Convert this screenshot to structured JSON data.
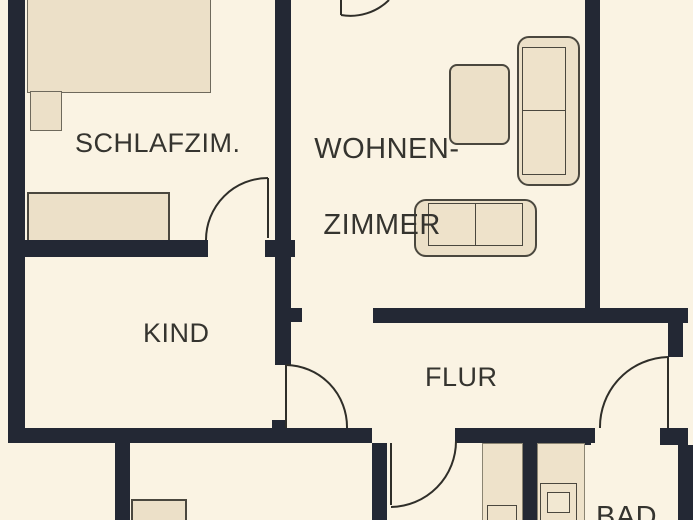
{
  "plan": {
    "type": "apartment-floor-plan",
    "language": "de"
  },
  "rooms": {
    "bedroom": {
      "label": "SCHLAFZIM."
    },
    "living": {
      "label_line1": "WOHNEN-",
      "label_line2": "ZIMMER"
    },
    "child": {
      "label": "KIND"
    },
    "hall": {
      "label": "FLUR"
    },
    "bath": {
      "label": "BAD"
    }
  },
  "furniture": {
    "bedroom": [
      "double-bed",
      "nightstand",
      "wardrobe"
    ],
    "living": [
      "armchair",
      "sofa-two-seat-right",
      "sofa-two-seat-bottom"
    ],
    "bath": [
      "cabinet-strip",
      "washer-fixture"
    ],
    "kitchen": [
      "counter-piece"
    ]
  },
  "doors": [
    "bedroom-to-child-door",
    "living-top-door",
    "child-to-hall-door",
    "apartment-entrance-door",
    "hall-to-kitchen-door"
  ],
  "colors": {
    "background": "#faf3e3",
    "wall": "#232834",
    "furniture_fill": "#ece0c8",
    "furniture_border": "#4a473e",
    "label_text": "#35342f",
    "door_arc": "#2f2e29"
  }
}
